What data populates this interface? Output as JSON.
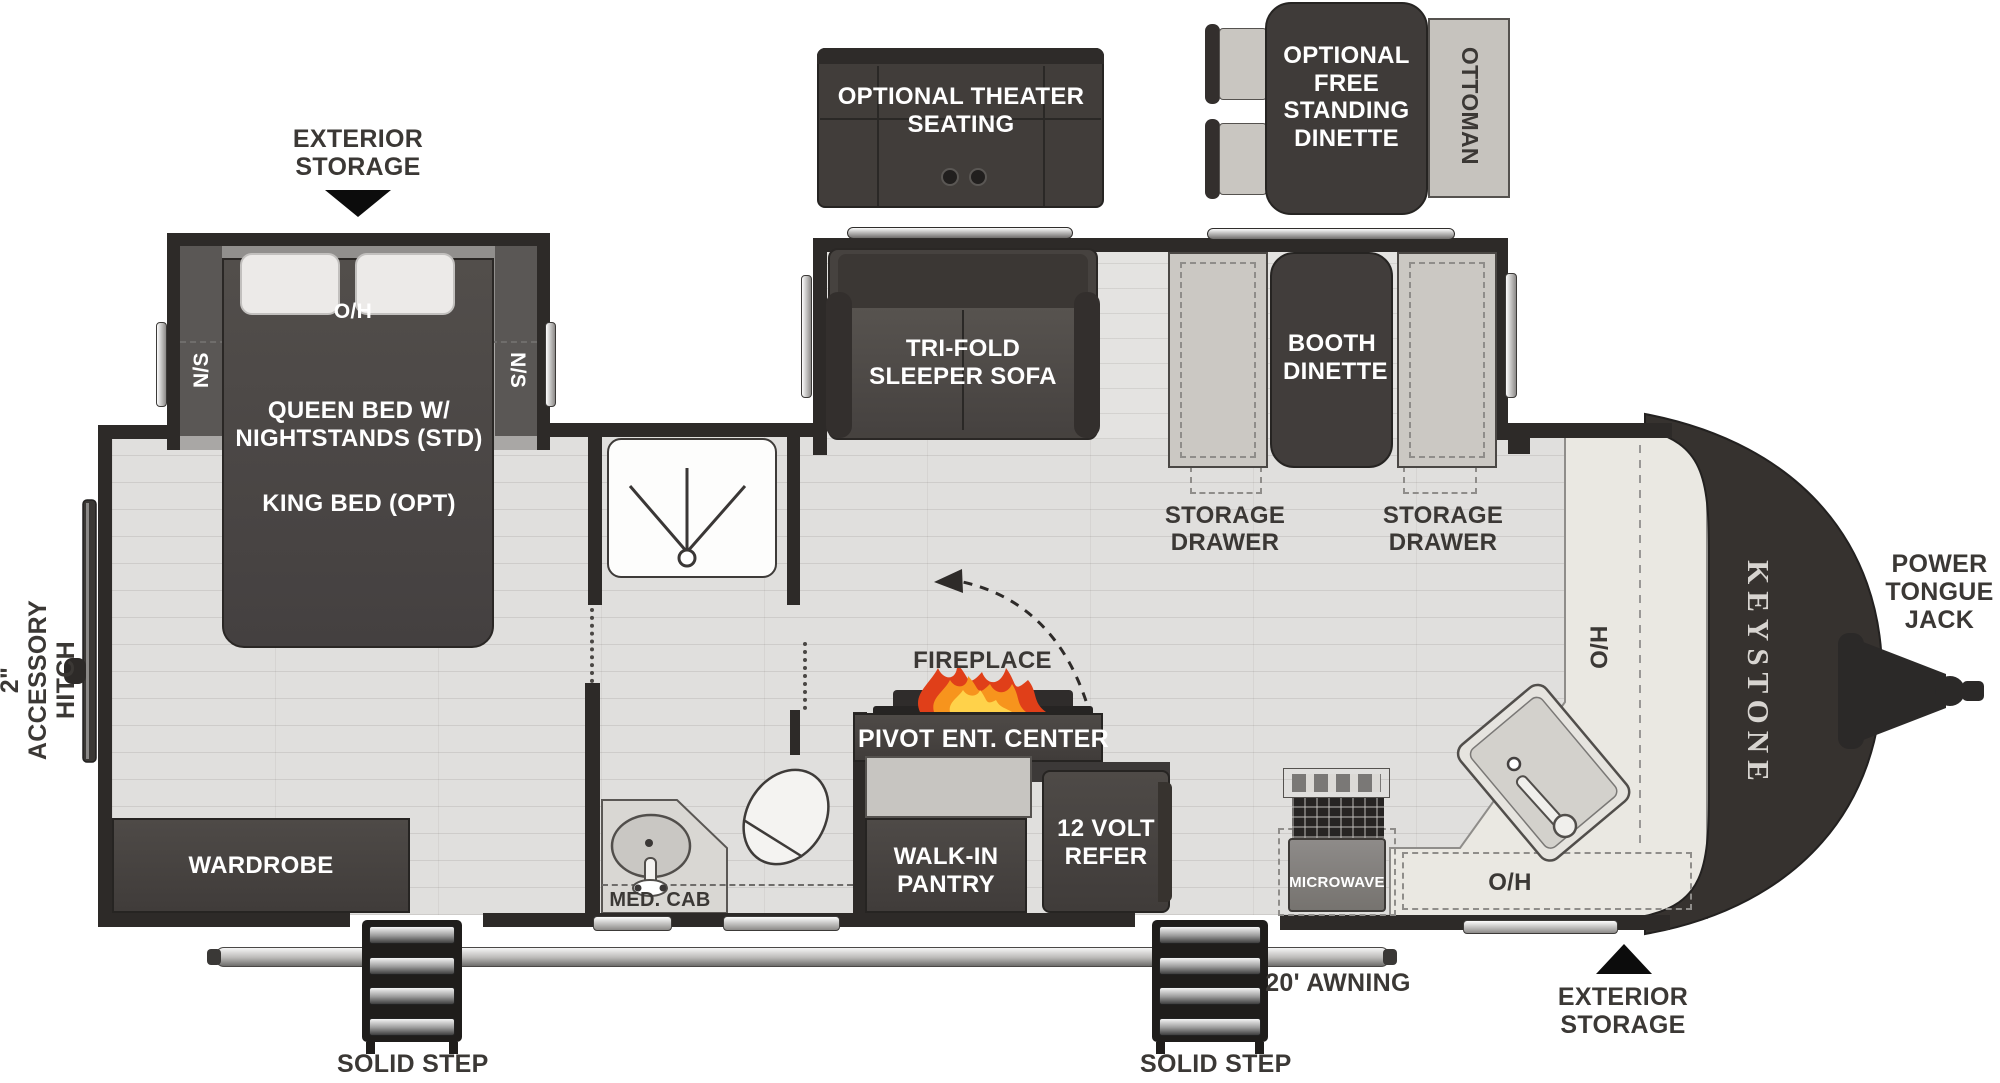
{
  "title": "Keystone travel trailer floor plan",
  "brand": {
    "logo_vertical": "KEYSTONE"
  },
  "exterior": {
    "storage_top": "EXTERIOR STORAGE",
    "storage_bottom": "EXTERIOR STORAGE",
    "accessory_hitch": "2\" ACCESSORY HITCH",
    "power_tongue_jack": "POWER TONGUE JACK",
    "awning": "20' AWNING",
    "solid_step_left": "SOLID STEP",
    "solid_step_right": "SOLID STEP"
  },
  "optional_furniture": {
    "theater_seating": "OPTIONAL THEATER SEATING",
    "free_standing_dinette": "OPTIONAL FREE STANDING DINETTE",
    "ottoman": "OTTOMAN"
  },
  "bedroom": {
    "overhead": "O/H",
    "nightstand_left": "N/S",
    "nightstand_right": "N/S",
    "bed_standard": "QUEEN BED W/ NIGHTSTANDS (STD)",
    "bed_option": "KING BED (OPT)",
    "wardrobe": "WARDROBE"
  },
  "bathroom": {
    "med_cab": "MED. CAB"
  },
  "living": {
    "sofa": "TRI-FOLD SLEEPER SOFA",
    "booth_dinette": "BOOTH DINETTE",
    "storage_drawer_left": "STORAGE DRAWER",
    "storage_drawer_right": "STORAGE DRAWER",
    "fireplace": "FIREPLACE",
    "pivot_ent_center": "PIVOT ENT. CENTER"
  },
  "kitchen": {
    "walk_in_pantry": "WALK-IN PANTRY",
    "refer": "12 VOLT REFER",
    "microwave": "MICROWAVE",
    "hutch_overhead": "H/O",
    "overhead": "O/H"
  },
  "colors": {
    "wall": "#2d2a28",
    "furniture_dark": "#433f3e",
    "bench": "#cbc8c3",
    "counter": "#eae8e2",
    "floor": "#e0dfdd",
    "flame_red": "#e03f19",
    "flame_orange": "#f7941d",
    "flame_yellow": "#ffd24a"
  }
}
